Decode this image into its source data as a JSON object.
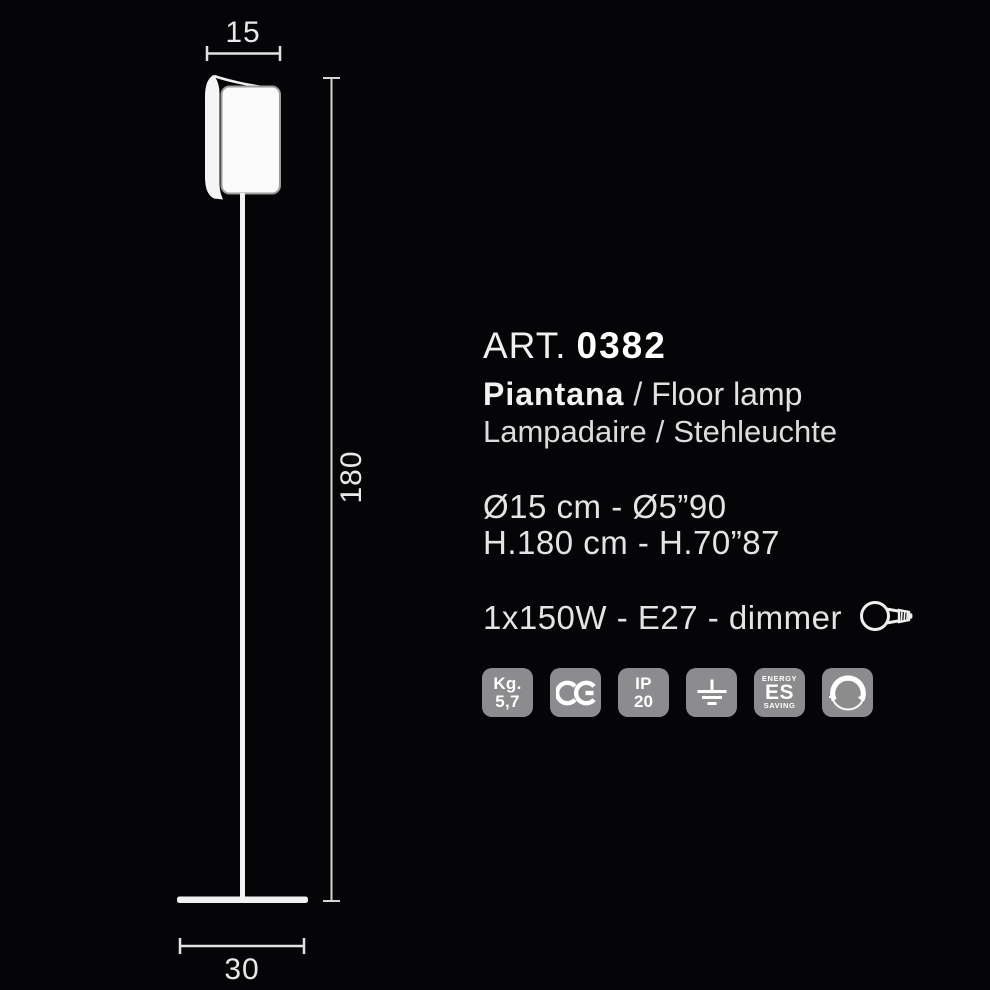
{
  "drawing": {
    "width_label": "15",
    "height_label": "180",
    "base_label": "30"
  },
  "info": {
    "art_prefix": "ART.",
    "art_number": "0382",
    "name_primary": "Piantana",
    "separator": "/",
    "name_en": "Floor lamp",
    "name_fr": "Lampadaire",
    "name_de": "Stehleuchte",
    "diameter_line": "Ø15 cm - Ø5”90",
    "height_line": "H.180 cm - H.70”87",
    "power_line": "1x150W - E27 - dimmer",
    "icons": {
      "bulb": "light-bulb-e27-icon",
      "ce": "ce-marking-icon",
      "ground": "earth-ground-icon",
      "dimmer": "dimmer-knob-icon"
    },
    "badges": {
      "weight": {
        "line1": "Kg.",
        "line2": "5,7"
      },
      "ip": {
        "line1": "IP",
        "line2": "20"
      },
      "energy": {
        "line1": "ENERGY",
        "line2": "ES",
        "line3": "SAVING"
      }
    }
  },
  "colors": {
    "background": "#050507",
    "line": "#f0f0f0",
    "text": "#e6e6e6",
    "badge_background": "#8c8c8e",
    "badge_text": "#ffffff"
  }
}
